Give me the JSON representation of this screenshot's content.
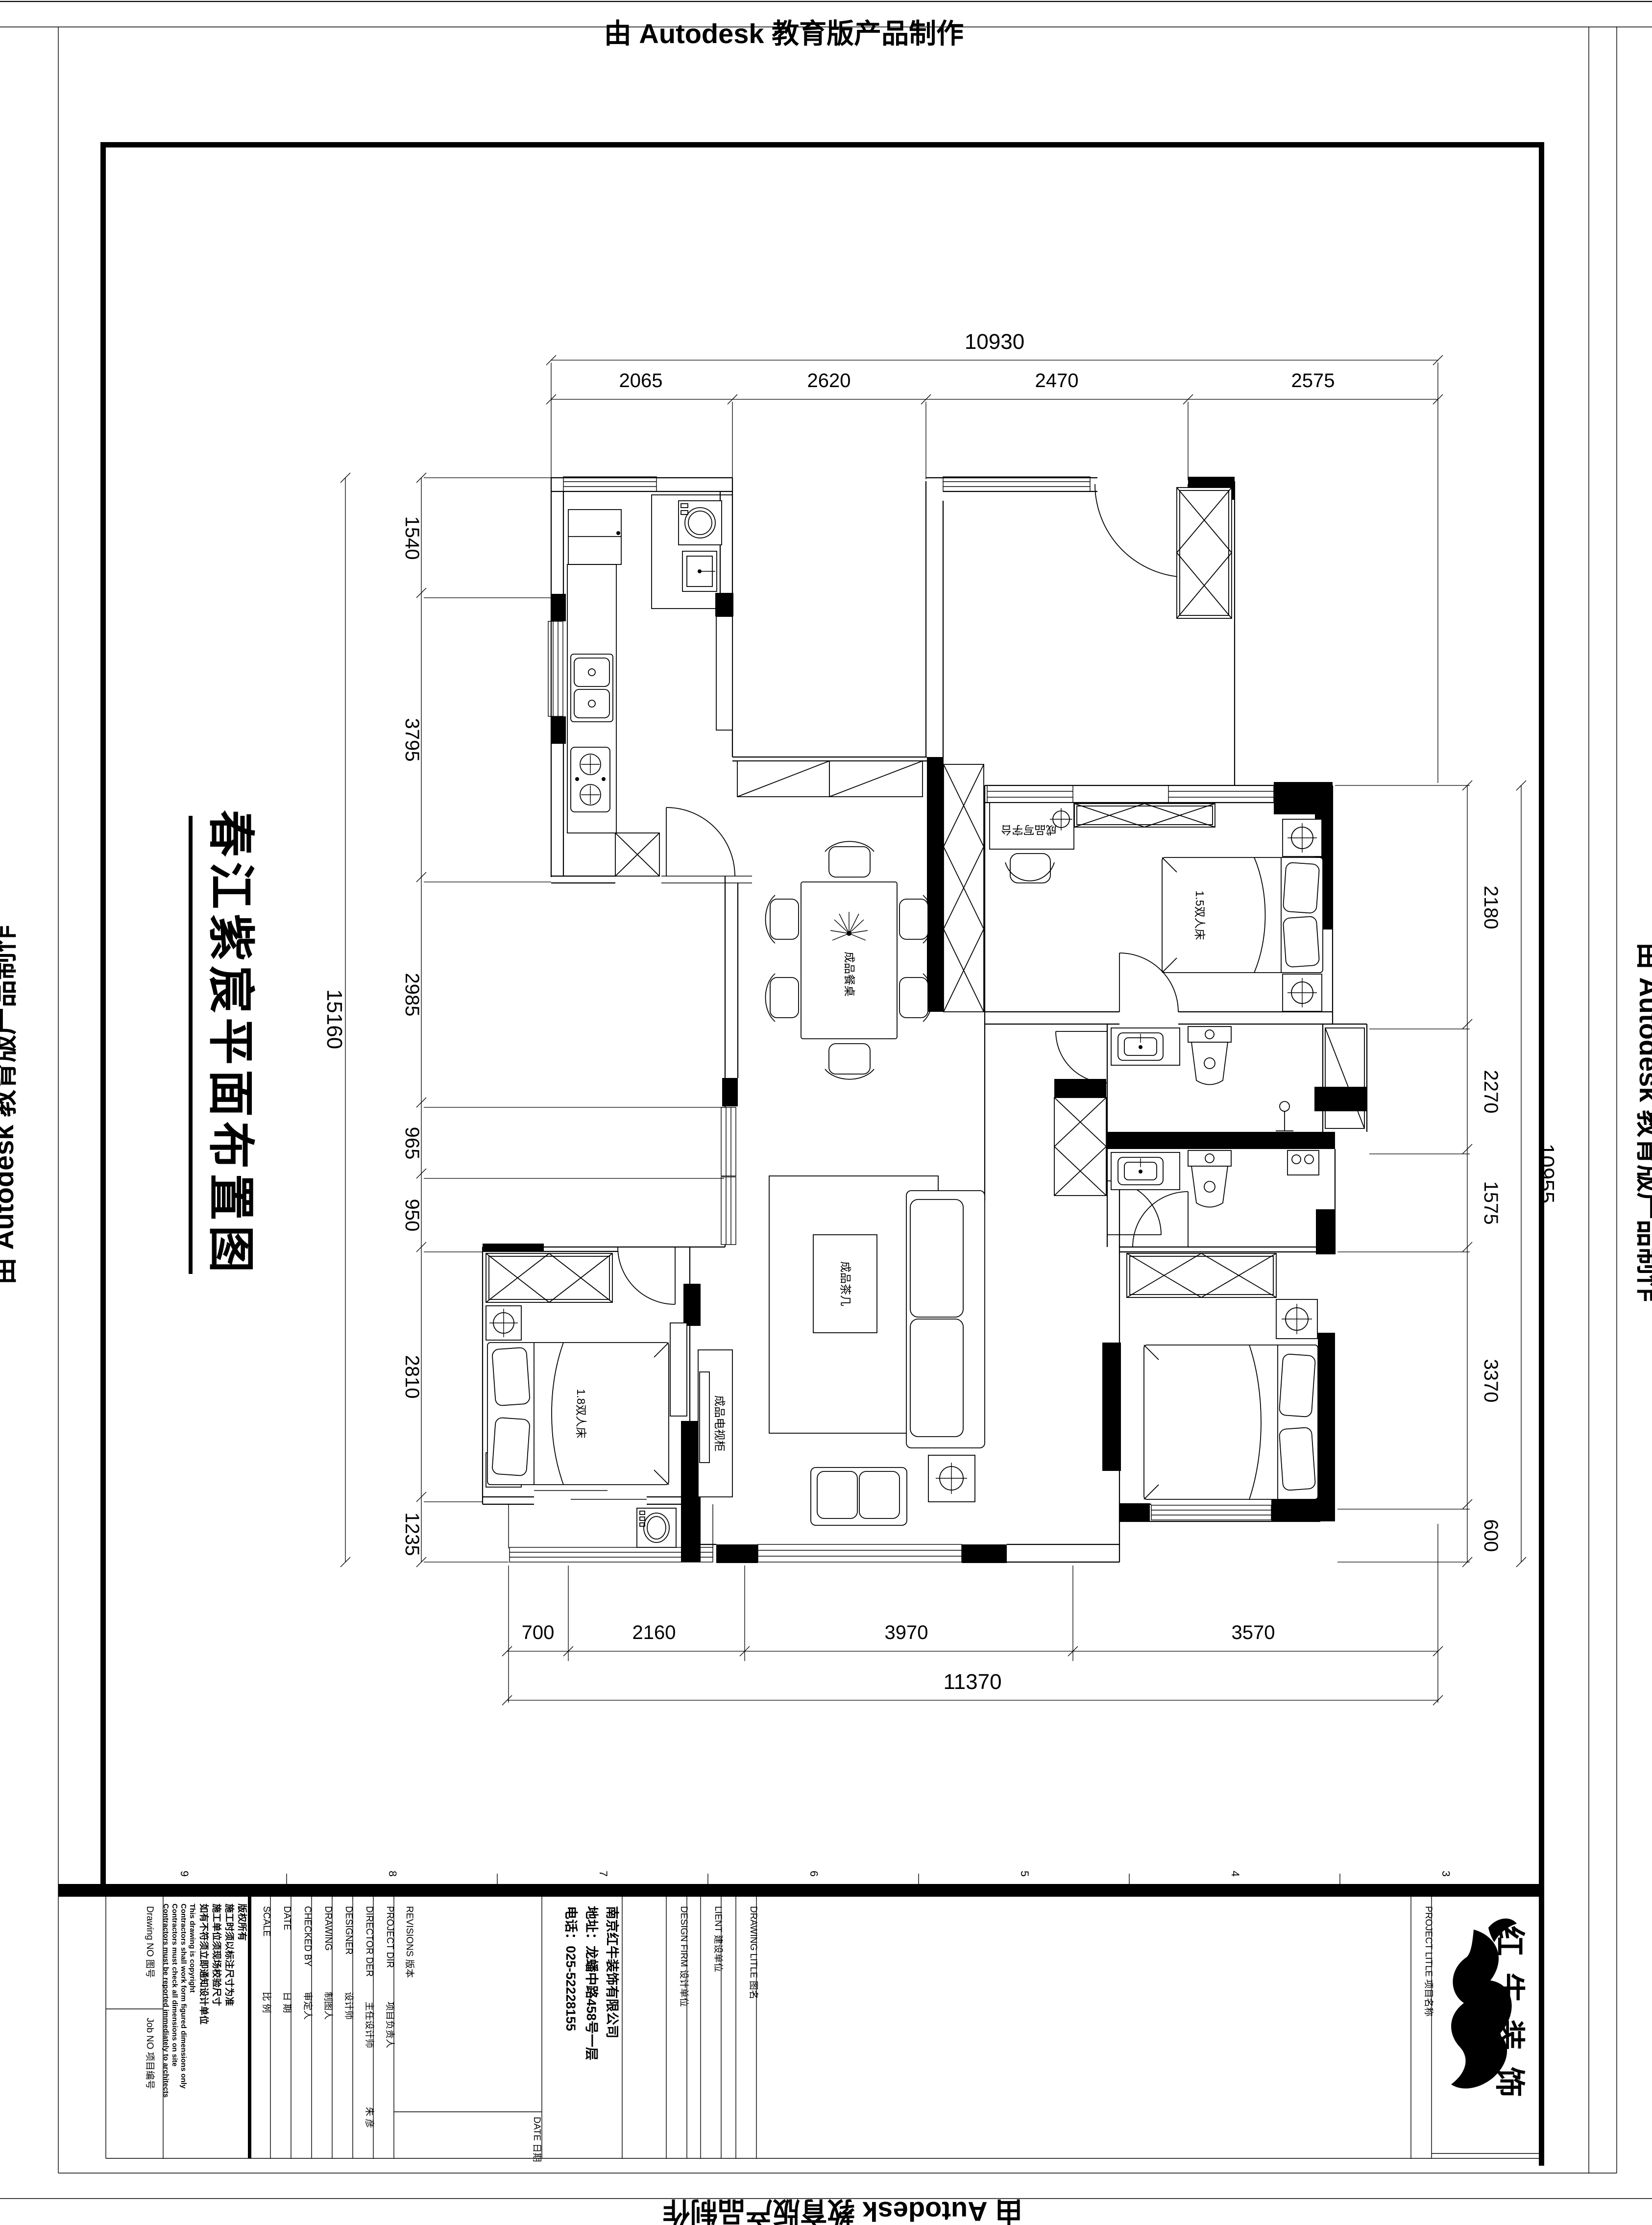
{
  "banners": {
    "top": "由 Autodesk 教育版产品制作",
    "bottom": "由 Autodesk 教育版产品制作",
    "left": "由 Autodesk 教育版产品制作",
    "right": "由 Autodesk 教育版产品制作"
  },
  "sheet_title": "春江紫宸平面布置图",
  "dims": {
    "top_total": "10930",
    "top": [
      "2065",
      "2620",
      "2470",
      "2575"
    ],
    "left_total": "15160",
    "left": [
      "1540",
      "3795",
      "2985",
      "965",
      "950",
      "2810",
      "1235"
    ],
    "right_total": "10955",
    "right": [
      "2180",
      "2270",
      "1575",
      "3370",
      "600"
    ],
    "bottom_total": "11370",
    "bottom": [
      "700",
      "2160",
      "3970",
      "3570"
    ]
  },
  "plan_labels": {
    "bed_small": "1.5双人床",
    "bed_big": "1.8双人床",
    "coffee_table": "成品茶几",
    "tv_cabinet": "成品电视柜",
    "dining_table": "成品餐桌",
    "desk": "成品写字台"
  },
  "grid_numbers": [
    "9",
    "8",
    "7",
    "6",
    "5",
    "4",
    "3"
  ],
  "titleblock": {
    "drawing_no": "Drawing NO  图号",
    "job_no": "Job NO  项目编号",
    "copyright_lines": [
      "版权所有",
      "施工时须以标注尺寸为准",
      "施工单位须现场校验尺寸",
      "如有不符须立即通知设计单位",
      "This drawing is copyright",
      "Contractors shall work form figured dimensions only",
      "Contractors must check all dimensions on site",
      "Contractors must be reported immediately to architects"
    ],
    "scale_en": "SCALE",
    "scale_zh": "比 例",
    "date_en": "DATE",
    "date_zh": "日 期",
    "checked_en": "CHECKED BY",
    "checked_zh": "审定人",
    "drawing_en": "DRAWING",
    "drawing_zh": "制图人",
    "designer_en": "DESIGNER",
    "designer_zh": "设计师",
    "director_en": "DIRECTOR DER",
    "director_zh": "主任设计师",
    "director_value": "朱 彦",
    "projectdir_en": "PROJECT DIR",
    "projectdir_zh": "项目负责人",
    "revisions": "REVISIONS  版本",
    "rev_date": "DATE  日期",
    "company_name": "南京红牛装饰有限公司",
    "company_address": "地址：龙蟠中路458号一层",
    "company_phone": "电话：025-52228155",
    "design_firm": "DESIGN FIRM  设计单位",
    "client": "LIENT  建设单位",
    "drawing_title": "DRAWING LITLE  图名",
    "project_title": "PROJECT LITLE  项目名称",
    "logo_text": "红牛装饰"
  }
}
